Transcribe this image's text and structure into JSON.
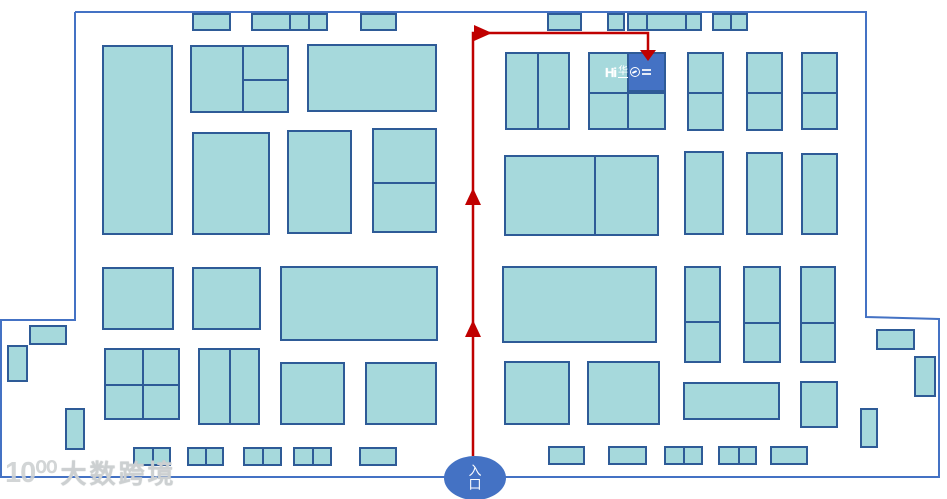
{
  "colors": {
    "booth_fill": "#A6D9DC",
    "booth_border": "#2E5B97",
    "outline_blue": "#4472C4",
    "route_red": "#C00000",
    "accent_blue": "#4472C4",
    "watermark_gray": "#D2D5D7"
  },
  "watermark": {
    "logo_mark": "10⁰⁰",
    "text": "大数跨境"
  },
  "entrance": {
    "label": "入口"
  },
  "destination": {
    "logo_prefix": "Hi",
    "logo_text": "华",
    "icon": "globe-icon"
  },
  "route": {
    "path": "M473,456 L473,33 L648,33 L648,52",
    "arrows": {
      "up1": "465,205 481,205 473,188",
      "up2": "465,337 481,337 473,320",
      "turn_right": "474,25 474,41 492,33",
      "down": "640,50 656,50 648,61"
    }
  },
  "map": {
    "outline_points": "75,12 866,12 866,317 939,319 939,477 1,477 1,320 75,320 75,12",
    "highlight": {
      "x": 627,
      "y": 52,
      "w": 39,
      "h": 40
    },
    "booths": [
      {
        "x": 192,
        "y": 13,
        "w": 39,
        "h": 18
      },
      {
        "x": 251,
        "y": 13,
        "w": 77,
        "h": 18,
        "vdiv": [
          38,
          57
        ]
      },
      {
        "x": 360,
        "y": 13,
        "w": 37,
        "h": 18
      },
      {
        "x": 547,
        "y": 13,
        "w": 35,
        "h": 18
      },
      {
        "x": 607,
        "y": 13,
        "w": 18,
        "h": 18
      },
      {
        "x": 627,
        "y": 13,
        "w": 75,
        "h": 18,
        "vdiv": [
          19,
          58
        ]
      },
      {
        "x": 712,
        "y": 13,
        "w": 36,
        "h": 18,
        "vdiv": [
          18
        ]
      },
      {
        "x": 102,
        "y": 45,
        "w": 71,
        "h": 190
      },
      {
        "x": 190,
        "y": 45,
        "w": 99,
        "h": 68,
        "vdiv": [
          52
        ],
        "hdiv": [
          {
            "at": 34,
            "from": 52,
            "to": 99
          }
        ]
      },
      {
        "x": 307,
        "y": 44,
        "w": 130,
        "h": 68
      },
      {
        "x": 192,
        "y": 132,
        "w": 78,
        "h": 103
      },
      {
        "x": 287,
        "y": 130,
        "w": 65,
        "h": 104
      },
      {
        "x": 372,
        "y": 128,
        "w": 65,
        "h": 105,
        "hdiv": [
          54
        ]
      },
      {
        "x": 102,
        "y": 267,
        "w": 72,
        "h": 63
      },
      {
        "x": 192,
        "y": 267,
        "w": 69,
        "h": 63
      },
      {
        "x": 280,
        "y": 266,
        "w": 158,
        "h": 75
      },
      {
        "x": 104,
        "y": 348,
        "w": 76,
        "h": 72,
        "vdiv": [
          38
        ],
        "hdiv": [
          36
        ]
      },
      {
        "x": 198,
        "y": 348,
        "w": 62,
        "h": 77,
        "vdiv": [
          31
        ]
      },
      {
        "x": 280,
        "y": 362,
        "w": 65,
        "h": 63
      },
      {
        "x": 365,
        "y": 362,
        "w": 72,
        "h": 63
      },
      {
        "x": 29,
        "y": 325,
        "w": 38,
        "h": 20
      },
      {
        "x": 7,
        "y": 345,
        "w": 21,
        "h": 37
      },
      {
        "x": 65,
        "y": 408,
        "w": 20,
        "h": 42
      },
      {
        "x": 133,
        "y": 447,
        "w": 38,
        "h": 19,
        "vdiv": [
          19
        ]
      },
      {
        "x": 187,
        "y": 447,
        "w": 37,
        "h": 19,
        "vdiv": [
          18
        ]
      },
      {
        "x": 243,
        "y": 447,
        "w": 39,
        "h": 19,
        "vdiv": [
          19
        ]
      },
      {
        "x": 293,
        "y": 447,
        "w": 39,
        "h": 19,
        "vdiv": [
          19
        ]
      },
      {
        "x": 359,
        "y": 447,
        "w": 38,
        "h": 19
      },
      {
        "x": 505,
        "y": 52,
        "w": 65,
        "h": 78,
        "vdiv": [
          32
        ]
      },
      {
        "x": 588,
        "y": 52,
        "w": 78,
        "h": 78,
        "vdiv": [
          39
        ],
        "hdiv": [
          40
        ]
      },
      {
        "x": 687,
        "y": 52,
        "w": 37,
        "h": 79,
        "hdiv": [
          40
        ]
      },
      {
        "x": 746,
        "y": 52,
        "w": 37,
        "h": 79,
        "hdiv": [
          40
        ]
      },
      {
        "x": 801,
        "y": 52,
        "w": 37,
        "h": 78,
        "hdiv": [
          40
        ]
      },
      {
        "x": 504,
        "y": 155,
        "w": 155,
        "h": 81,
        "vdiv": [
          90
        ]
      },
      {
        "x": 684,
        "y": 151,
        "w": 40,
        "h": 84
      },
      {
        "x": 746,
        "y": 152,
        "w": 37,
        "h": 83
      },
      {
        "x": 801,
        "y": 153,
        "w": 37,
        "h": 82
      },
      {
        "x": 502,
        "y": 266,
        "w": 155,
        "h": 77
      },
      {
        "x": 684,
        "y": 266,
        "w": 37,
        "h": 97,
        "hdiv": [
          55
        ]
      },
      {
        "x": 743,
        "y": 266,
        "w": 38,
        "h": 97,
        "hdiv": [
          56
        ]
      },
      {
        "x": 800,
        "y": 266,
        "w": 36,
        "h": 97,
        "hdiv": [
          56
        ]
      },
      {
        "x": 504,
        "y": 361,
        "w": 66,
        "h": 64
      },
      {
        "x": 587,
        "y": 361,
        "w": 73,
        "h": 64
      },
      {
        "x": 683,
        "y": 382,
        "w": 97,
        "h": 38
      },
      {
        "x": 800,
        "y": 381,
        "w": 38,
        "h": 47
      },
      {
        "x": 876,
        "y": 329,
        "w": 39,
        "h": 21
      },
      {
        "x": 914,
        "y": 356,
        "w": 22,
        "h": 41
      },
      {
        "x": 860,
        "y": 408,
        "w": 18,
        "h": 40
      },
      {
        "x": 548,
        "y": 446,
        "w": 37,
        "h": 19
      },
      {
        "x": 608,
        "y": 446,
        "w": 39,
        "h": 19
      },
      {
        "x": 664,
        "y": 446,
        "w": 39,
        "h": 19,
        "vdiv": [
          19
        ]
      },
      {
        "x": 718,
        "y": 446,
        "w": 39,
        "h": 19,
        "vdiv": [
          20
        ]
      },
      {
        "x": 770,
        "y": 446,
        "w": 38,
        "h": 19
      }
    ]
  }
}
